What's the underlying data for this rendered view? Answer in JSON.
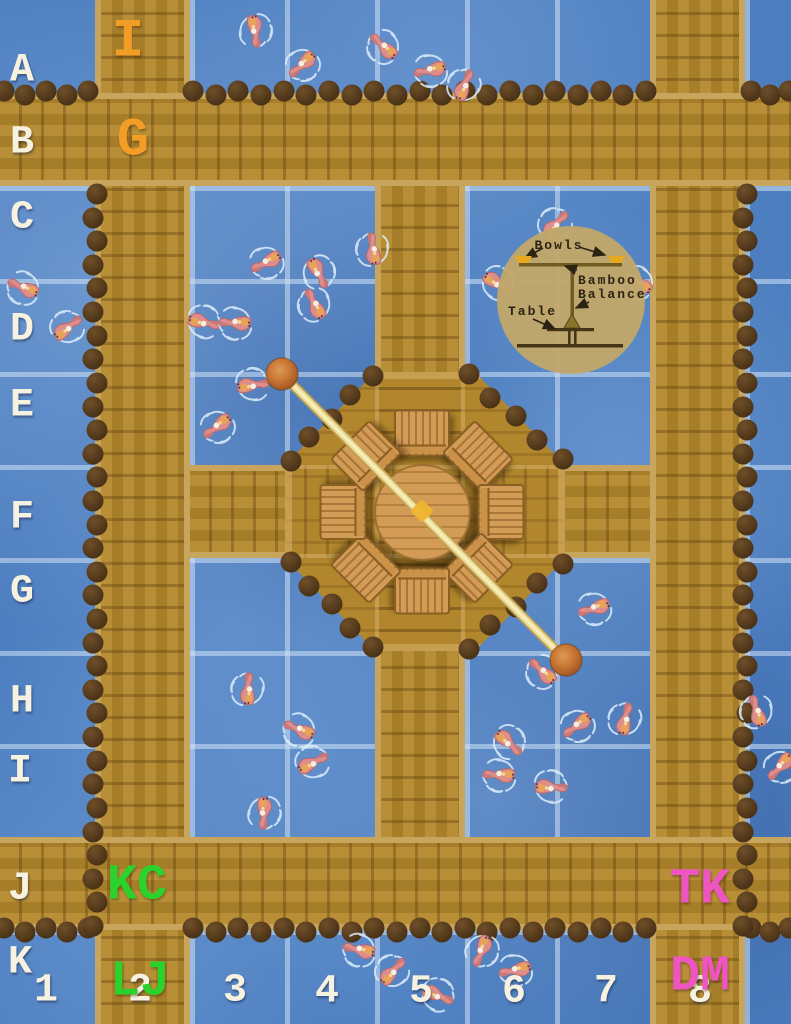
{
  "map_kind": "koi-pond-battle-map",
  "colors": {
    "water": "#4c7ec0",
    "wood": "#b1862c",
    "wood_light": "#c8a55d",
    "piling": "#4a3217",
    "label_white": "#f7f2df",
    "label_orange": "#f29d26",
    "label_green": "#2cd22c",
    "label_pink": "#ee55c0",
    "pole": "#eee09c",
    "ball": "#cd7b36",
    "inset_bg": "#c2a76a",
    "inset_ink": "#2c2312",
    "bowl_yellow": "#e6a81e"
  },
  "grid": {
    "v_lines": [
      95,
      190,
      285,
      375,
      465,
      555,
      650,
      745
    ],
    "h_lines": [
      93,
      186,
      279,
      372,
      465,
      558,
      651,
      744,
      837,
      930
    ],
    "row_labels": [
      {
        "text": "A",
        "x": 22,
        "y": 71
      },
      {
        "text": "B",
        "x": 22,
        "y": 143
      },
      {
        "text": "C",
        "x": 22,
        "y": 218
      },
      {
        "text": "D",
        "x": 22,
        "y": 330
      },
      {
        "text": "E",
        "x": 22,
        "y": 406
      },
      {
        "text": "F",
        "x": 22,
        "y": 518
      },
      {
        "text": "G",
        "x": 22,
        "y": 592
      },
      {
        "text": "H",
        "x": 22,
        "y": 702
      },
      {
        "text": "I",
        "x": 20,
        "y": 772
      },
      {
        "text": "J",
        "x": 20,
        "y": 889
      },
      {
        "text": "K",
        "x": 20,
        "y": 963
      }
    ],
    "col_labels": [
      {
        "text": "1",
        "x": 46,
        "y": 991
      },
      {
        "text": "2",
        "x": 140,
        "y": 991
      },
      {
        "text": "3",
        "x": 235,
        "y": 991
      },
      {
        "text": "4",
        "x": 327,
        "y": 992
      },
      {
        "text": "5",
        "x": 421,
        "y": 992
      },
      {
        "text": "6",
        "x": 514,
        "y": 992
      },
      {
        "text": "7",
        "x": 606,
        "y": 992
      },
      {
        "text": "8",
        "x": 700,
        "y": 992
      }
    ]
  },
  "zone_labels": [
    {
      "text": "I",
      "color": "#f29d26",
      "x": 128,
      "y": 42,
      "size": 54
    },
    {
      "text": "G",
      "color": "#f29d26",
      "x": 133,
      "y": 141,
      "size": 54
    },
    {
      "text": "KC",
      "color": "#2cd22c",
      "x": 137,
      "y": 886,
      "size": 50
    },
    {
      "text": "TK",
      "color": "#ee55c0",
      "x": 700,
      "y": 890,
      "size": 50
    },
    {
      "text": "LJ",
      "color": "#2cd22c",
      "x": 140,
      "y": 982,
      "size": 50
    },
    {
      "text": "DM",
      "color": "#ee55c0",
      "x": 700,
      "y": 977,
      "size": 50
    }
  ],
  "inset": {
    "bowls_label": "Bowls",
    "balance_line1": "Bamboo",
    "balance_line2": "Balance",
    "table_label": "Table"
  },
  "balance": {
    "x1": 282,
    "y1": 374,
    "x2": 566,
    "y2": 660,
    "ball_r": 16,
    "hub_x": 422,
    "hub_y": 511
  },
  "stools": [
    {
      "x": 422,
      "y": 433,
      "rot": 0
    },
    {
      "x": 478,
      "y": 456,
      "rot": 45
    },
    {
      "x": 501,
      "y": 512,
      "rot": 90
    },
    {
      "x": 478,
      "y": 568,
      "rot": 135
    },
    {
      "x": 422,
      "y": 591,
      "rot": 180
    },
    {
      "x": 366,
      "y": 568,
      "rot": 225
    },
    {
      "x": 343,
      "y": 512,
      "rot": 270
    },
    {
      "x": 366,
      "y": 456,
      "rot": 315
    }
  ],
  "pilings": {
    "diameter": 21,
    "lines": [
      {
        "x1": 4,
        "y1": 93,
        "x2": 88,
        "y2": 93,
        "s": 23
      },
      {
        "x1": 193,
        "y1": 93,
        "x2": 646,
        "y2": 93,
        "s": 23
      },
      {
        "x1": 751,
        "y1": 93,
        "x2": 789,
        "y2": 93,
        "s": 23
      },
      {
        "x1": 4,
        "y1": 930,
        "x2": 88,
        "y2": 930,
        "s": 23
      },
      {
        "x1": 193,
        "y1": 930,
        "x2": 646,
        "y2": 930,
        "s": 23
      },
      {
        "x1": 751,
        "y1": 930,
        "x2": 789,
        "y2": 930,
        "s": 23
      },
      {
        "x1": 95,
        "y1": 194,
        "x2": 95,
        "y2": 926,
        "s": 24
      },
      {
        "x1": 745,
        "y1": 194,
        "x2": 745,
        "y2": 926,
        "s": 24
      },
      {
        "x1": 372,
        "y1": 375,
        "x2": 290,
        "y2": 460,
        "s": 30
      },
      {
        "x1": 468,
        "y1": 375,
        "x2": 562,
        "y2": 460,
        "s": 30
      },
      {
        "x1": 290,
        "y1": 563,
        "x2": 372,
        "y2": 648,
        "s": 30
      },
      {
        "x1": 562,
        "y1": 563,
        "x2": 468,
        "y2": 648,
        "s": 30
      }
    ]
  },
  "fish": [
    {
      "x": 255,
      "y": 30,
      "rot": 320
    },
    {
      "x": 303,
      "y": 64,
      "rot": 15
    },
    {
      "x": 384,
      "y": 47,
      "rot": 100
    },
    {
      "x": 431,
      "y": 70,
      "rot": 45
    },
    {
      "x": 464,
      "y": 86,
      "rot": 170
    },
    {
      "x": 24,
      "y": 288,
      "rot": 80
    },
    {
      "x": 67,
      "y": 328,
      "rot": 200
    },
    {
      "x": 267,
      "y": 262,
      "rot": 30
    },
    {
      "x": 318,
      "y": 272,
      "rot": 300
    },
    {
      "x": 373,
      "y": 250,
      "rot": 140
    },
    {
      "x": 203,
      "y": 322,
      "rot": 250
    },
    {
      "x": 236,
      "y": 323,
      "rot": 60
    },
    {
      "x": 315,
      "y": 305,
      "rot": 120
    },
    {
      "x": 555,
      "y": 225,
      "rot": 190
    },
    {
      "x": 638,
      "y": 283,
      "rot": 90
    },
    {
      "x": 497,
      "y": 283,
      "rot": 270
    },
    {
      "x": 218,
      "y": 426,
      "rot": 20
    },
    {
      "x": 252,
      "y": 385,
      "rot": 230
    },
    {
      "x": 595,
      "y": 608,
      "rot": 40
    },
    {
      "x": 248,
      "y": 690,
      "rot": 150
    },
    {
      "x": 300,
      "y": 730,
      "rot": 80
    },
    {
      "x": 312,
      "y": 763,
      "rot": 210
    },
    {
      "x": 264,
      "y": 812,
      "rot": 330
    },
    {
      "x": 543,
      "y": 672,
      "rot": 100
    },
    {
      "x": 578,
      "y": 725,
      "rot": 20
    },
    {
      "x": 625,
      "y": 720,
      "rot": 160
    },
    {
      "x": 508,
      "y": 742,
      "rot": 280
    },
    {
      "x": 500,
      "y": 775,
      "rot": 60
    },
    {
      "x": 550,
      "y": 787,
      "rot": 240
    },
    {
      "x": 757,
      "y": 712,
      "rot": 130
    },
    {
      "x": 781,
      "y": 766,
      "rot": 10
    },
    {
      "x": 360,
      "y": 950,
      "rot": 70
    },
    {
      "x": 392,
      "y": 972,
      "rot": 190
    },
    {
      "x": 437,
      "y": 995,
      "rot": 260
    },
    {
      "x": 482,
      "y": 950,
      "rot": 350
    },
    {
      "x": 516,
      "y": 970,
      "rot": 45
    }
  ]
}
